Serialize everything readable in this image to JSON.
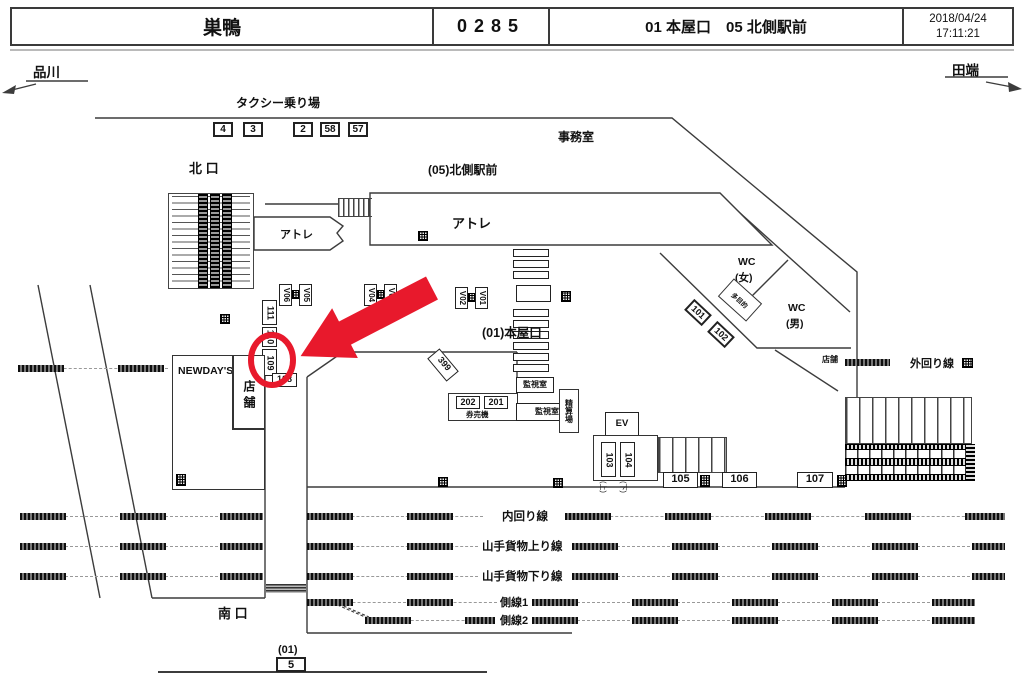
{
  "header": {
    "station": "巣鴨",
    "code": "0285",
    "gate_info": "01 本屋口　05 北側駅前",
    "date": "2018/04/24",
    "time": "17:11:21"
  },
  "directions": {
    "left": "品川",
    "right": "田端"
  },
  "area_labels": {
    "taxi": "タクシー乗り場",
    "north_exit": "北 口",
    "north_front": "(05)北側駅前",
    "office": "事務室",
    "atre_small": "アトレ",
    "atre_large": "アトレ",
    "main_gate": "(01)本屋口",
    "wc_w_line1": "WC",
    "wc_w_line2": "(女)",
    "wc_m_line1": "WC",
    "wc_m_line2": "(男)",
    "multipurpose": "多目的",
    "shop_right": "店舗",
    "newdays": "NEWDAY'S",
    "shop_vertical": "店舗",
    "monitor_upper": "監視室",
    "monitor_lower": "監視室",
    "ticket_machines": "券売機",
    "fare_adjust": "精算場",
    "elevator": "EV",
    "south_exit": "南 口",
    "south_area": "(01)",
    "up": "(上)",
    "down": "(下)"
  },
  "tracks": {
    "outer_loop": "外回り線",
    "inner_loop": "内回り線",
    "freight_up": "山手貨物上り線",
    "freight_down": "山手貨物下り線",
    "siding1": "側線1",
    "siding2": "側線2"
  },
  "cameras": {
    "north_row": [
      "4",
      "3",
      "2",
      "58",
      "57"
    ],
    "v_row": [
      "V06",
      "V05",
      "V04",
      "V03",
      "V02",
      "V01"
    ],
    "stack": [
      "111",
      "110",
      "109"
    ],
    "c108": "108",
    "c399": "399",
    "gate_boxes": [
      "202",
      "201"
    ],
    "wall_boxes": [
      "101",
      "102"
    ],
    "c103": "103",
    "c104": "104",
    "platform_row": [
      "105",
      "106",
      "107"
    ],
    "south": "5"
  },
  "highlight": {
    "target": "109",
    "color": "#e8192c"
  }
}
